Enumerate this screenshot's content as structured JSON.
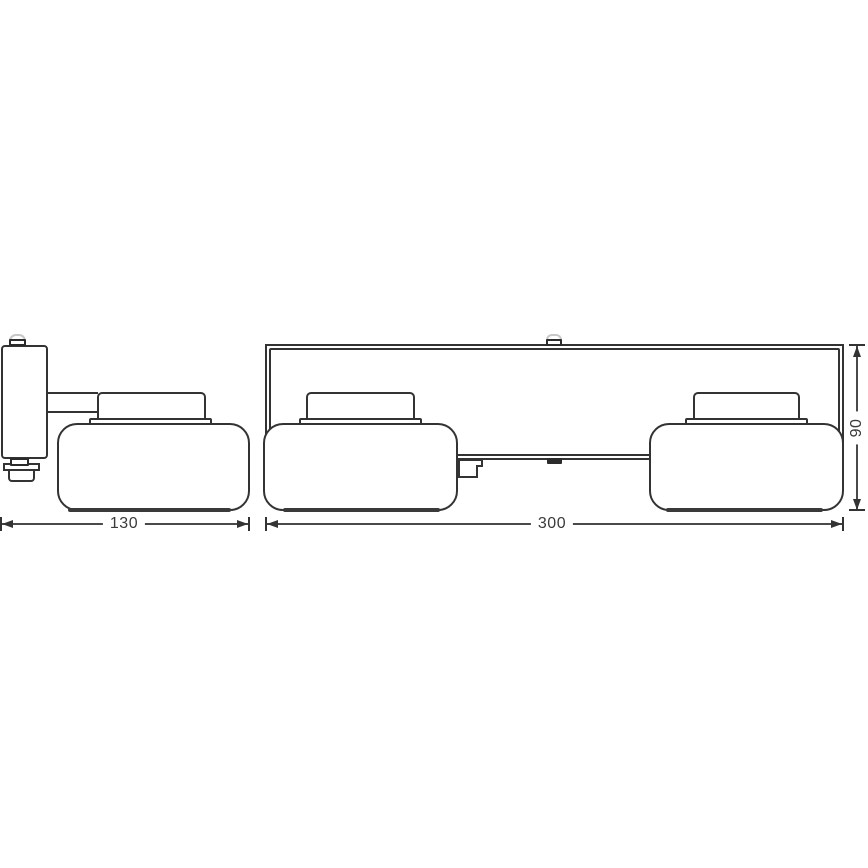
{
  "meta": {
    "type": "technical-dimension-drawing",
    "subject": "two-head wall light fixture, side view and front view"
  },
  "colors": {
    "background": "#ffffff",
    "line": "#333333",
    "dimension_line": "#4a4a4a",
    "tab_dark": "#2b2b2b",
    "text": "#3a3a3a"
  },
  "dimensions": {
    "side_width": {
      "value": "130"
    },
    "front_width": {
      "value": "300"
    },
    "front_height": {
      "value": "90"
    }
  }
}
